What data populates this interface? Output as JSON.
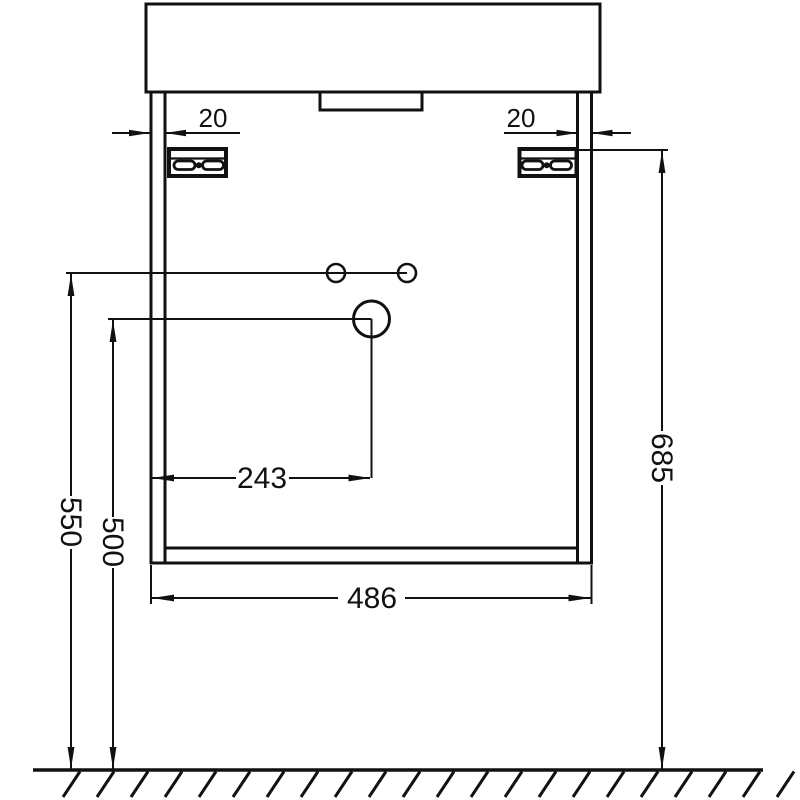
{
  "diagram": {
    "dimensions": {
      "panel_thickness_left": "20",
      "panel_thickness_right": "20",
      "holes_height_from_floor": "550",
      "drain_height_from_floor": "500",
      "drain_offset_from_side": "243",
      "cabinet_width": "486",
      "bracket_height_from_floor": "685"
    },
    "colors": {
      "line": "#111111",
      "background": "#ffffff"
    }
  }
}
